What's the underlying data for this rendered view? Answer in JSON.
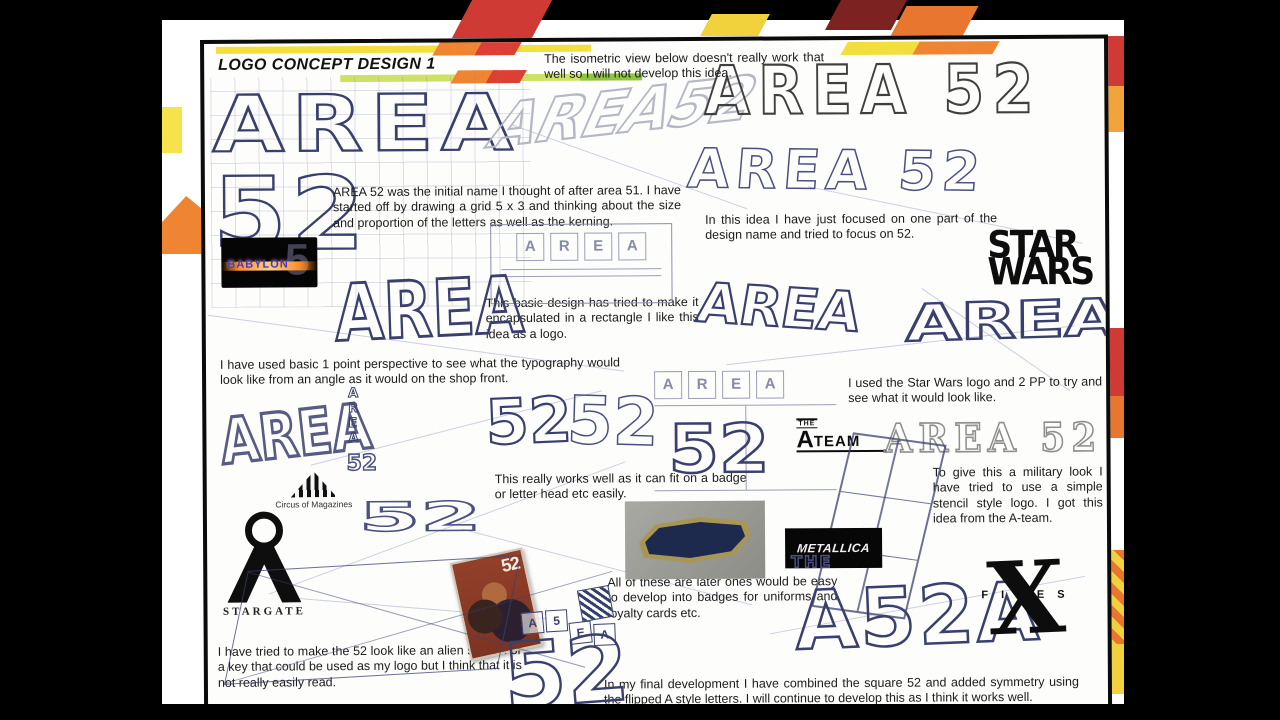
{
  "title": {
    "text": "LOGO CONCEPT DESIGN 1"
  },
  "paragraphs": {
    "isometric": "The isometric view below doesn't really work that well so I will not develop this idea.",
    "initial_name": "AREA 52 was the initial name I thought of after area 51. I have started off by drawing a grid 5 x 3 and thinking about the size and proportion of the letters as well as the kerning.",
    "focused_52": "In this idea I have just focused on one part of the design name and tried to focus on 52.",
    "basic_design": "This basic design has tried to make it encapsulated in a rectangle I like this idea as a logo.",
    "perspective": "I have used basic 1 point perspective to see what the typography would look like  from an angle as it would on the shop front.",
    "star_wars_note": "I used the Star Wars logo and 2 PP to try and see what it would look like.",
    "badge_note": "This really works well as it can fit on a badge or letter head etc easily.",
    "military": "To give this a military look I have tried to use a simple stencil style logo. I got this idea from the A-team.",
    "badges_later": "All of these are later ones would be easy to develop into badges for uniforms and loyalty cards etc.",
    "alien_symbol": "I have tried to make the 52 look like an alien symbol or a key that could be used as my logo but I think that it is not really easily read.",
    "final": "In my final development I have combined the square 52 and added symmetry using the flipped A style letters. I will continue to develop this as I think it works well."
  },
  "logos": {
    "babylon5": {
      "name": "BABYLON",
      "number": "5"
    },
    "star_wars": {
      "line1": "STAR",
      "line2": "WARS"
    },
    "circus": {
      "label": "Circus of Magazines"
    },
    "stargate": {
      "label": "STARGATE"
    },
    "a_team": {
      "the": "THE",
      "a": "A",
      "team": "TEAM"
    },
    "metallica": {
      "text": "METALLICA"
    },
    "x_files": {
      "x": "X",
      "files": "FILES"
    },
    "stencil": {
      "text": "AREA 52"
    }
  },
  "sketches": {
    "grid_area": "AREA",
    "grid_52": "52",
    "iso": "AREA52",
    "block_top": "AREA 52",
    "block_second": "AREA 52",
    "ink_left": "AREA",
    "boxed_letters": [
      "A",
      "R",
      "E",
      "A"
    ],
    "badge_letters": [
      "A",
      "R",
      "E",
      "A"
    ],
    "badge_52": "52",
    "persp_mid": "AREA",
    "pyramid": "AREA",
    "vertical": "AREA",
    "vertical_52": "52",
    "big_52_a": "52",
    "big_52_b": "52",
    "wide_52": "52",
    "rough_left": "AREA",
    "bottom_52": "52",
    "tiles": [
      "A",
      "5",
      "E",
      "A"
    ],
    "the": "THE",
    "final_glyphs": "A52A",
    "comic_52": "52"
  },
  "colors": {
    "yellow": "#f2de3c",
    "orange": "#ef8532",
    "red": "#d23b33",
    "maroon": "#7c2220",
    "green": "#8fc43f",
    "light_green": "#cfe066",
    "ink": "#39406e"
  }
}
